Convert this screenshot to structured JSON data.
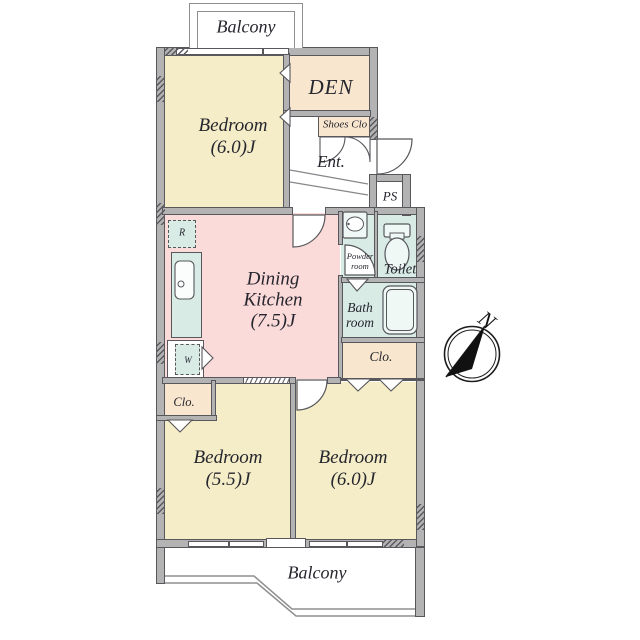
{
  "plan": {
    "balcony_top": "Balcony",
    "balcony_bottom": "Balcony",
    "bedroom_top": {
      "name": "Bedroom",
      "size": "(6.0)J"
    },
    "den": "DEN",
    "shoes_closet": "Shoes Clo",
    "entrance": "Ent.",
    "pipe_shaft": "PS",
    "powder_room": {
      "line1": "Powder",
      "line2": "room"
    },
    "toilet": "Toilet",
    "bathroom": {
      "line1": "Bath",
      "line2": "room"
    },
    "dining_kitchen": {
      "line1": "Dining",
      "line2": "Kitchen",
      "size": "(7.5)J"
    },
    "closet_right": "Clo.",
    "closet_left": "Clo.",
    "bedroom_left": {
      "name": "Bedroom",
      "size": "(5.5)J"
    },
    "bedroom_right": {
      "name": "Bedroom",
      "size": "(6.0)J"
    },
    "refrigerator": "R",
    "washer": "W",
    "compass_north": "N"
  },
  "palette": {
    "bedroom_fill": "#F5EDC8",
    "service_fill": "#F8E6CE",
    "dining_kitchen_fill": "#FBDADA",
    "wet_area_fill": "#D8EBE5",
    "wall_fill": "#B3B3B3",
    "outline": "#57575C",
    "balcony_rail": "#8F8F8F",
    "text": "#26262E"
  }
}
